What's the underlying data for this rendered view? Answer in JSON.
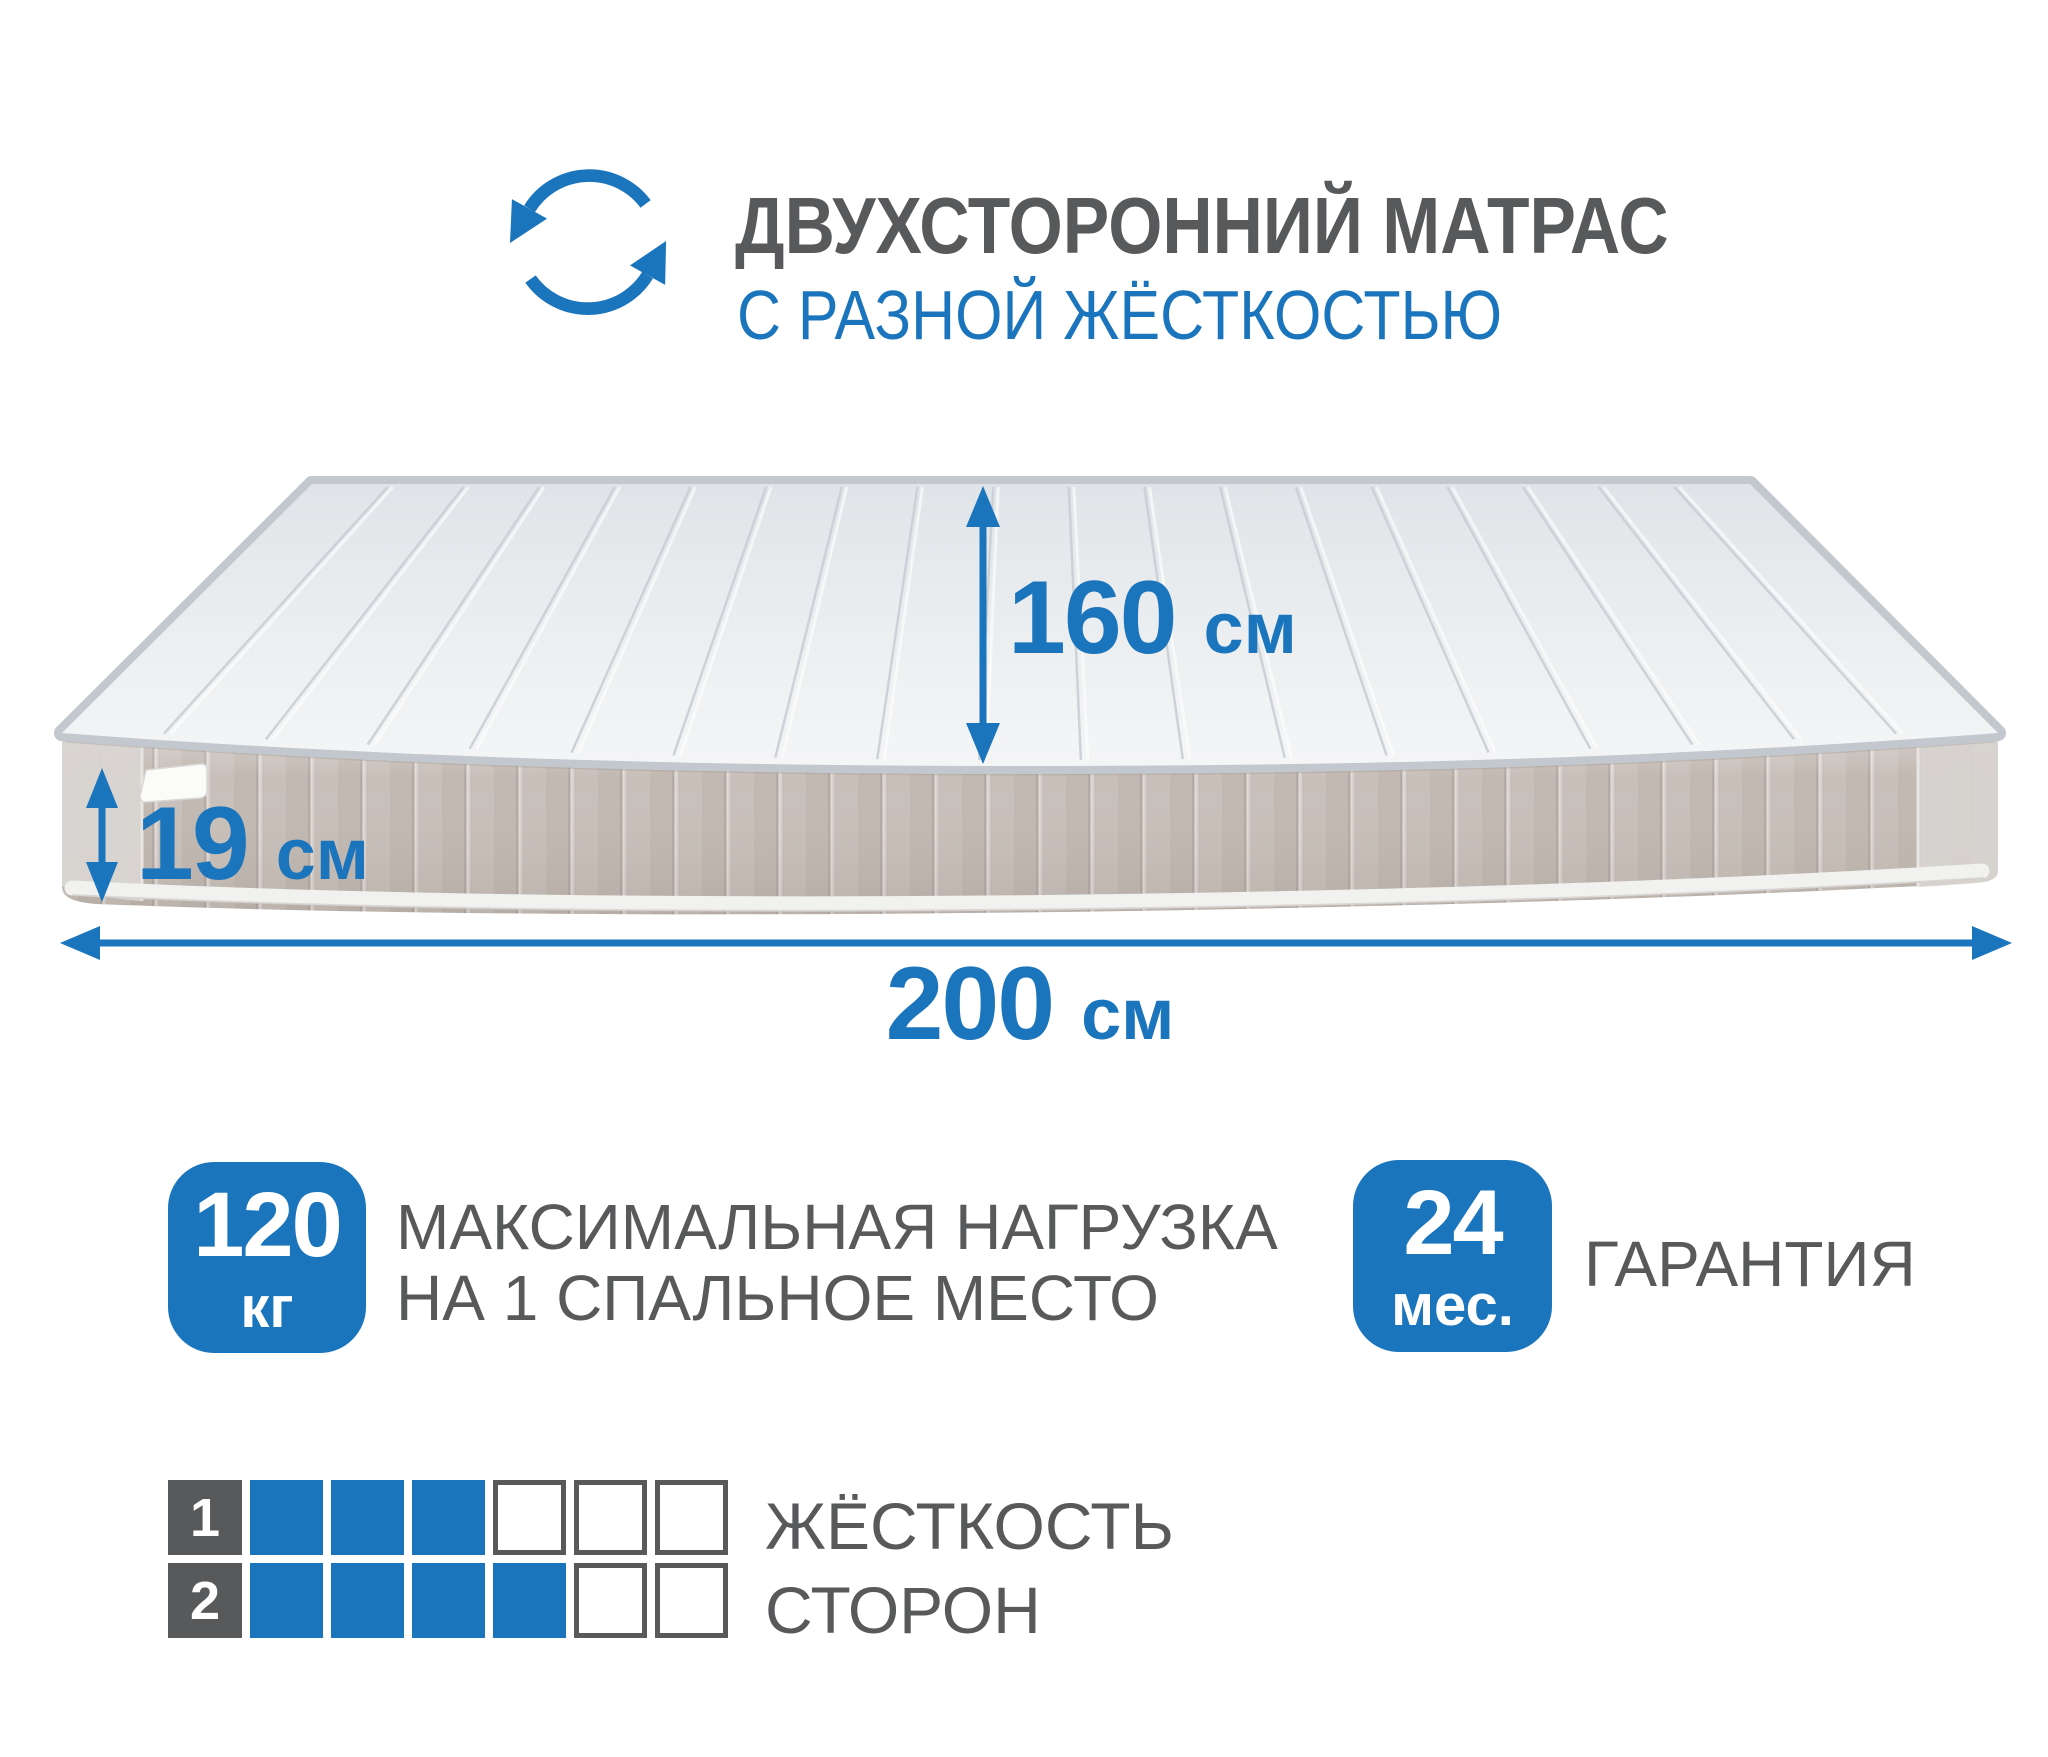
{
  "header": {
    "title": "ДВУХСТОРОННИЙ МАТРАС",
    "subtitle": "С РАЗНОЙ ЖЁСТКОСТЬЮ",
    "icon": "rotate-arrows-icon"
  },
  "dimensions": {
    "width": {
      "value": "160",
      "unit": "см"
    },
    "height": {
      "value": "19",
      "unit": "см"
    },
    "length": {
      "value": "200",
      "unit": "см"
    }
  },
  "features": {
    "max_load": {
      "value": "120",
      "unit": "кг",
      "label_line1": "МАКСИМАЛЬНАЯ НАГРУЗКА",
      "label_line2": "НА 1 СПАЛЬНОЕ МЕСТО"
    },
    "warranty": {
      "value": "24",
      "unit": "мес.",
      "label": "ГАРАНТИЯ"
    }
  },
  "firmness": {
    "label_line1": "ЖЁСТКОСТЬ",
    "label_line2": "СТОРОН",
    "scale_max": 6,
    "rows": [
      {
        "label": "1",
        "filled": 3,
        "total": 6
      },
      {
        "label": "2",
        "filled": 4,
        "total": 6
      }
    ]
  },
  "colors": {
    "accent_blue": "#1B75BC",
    "text_gray": "#58595B"
  }
}
